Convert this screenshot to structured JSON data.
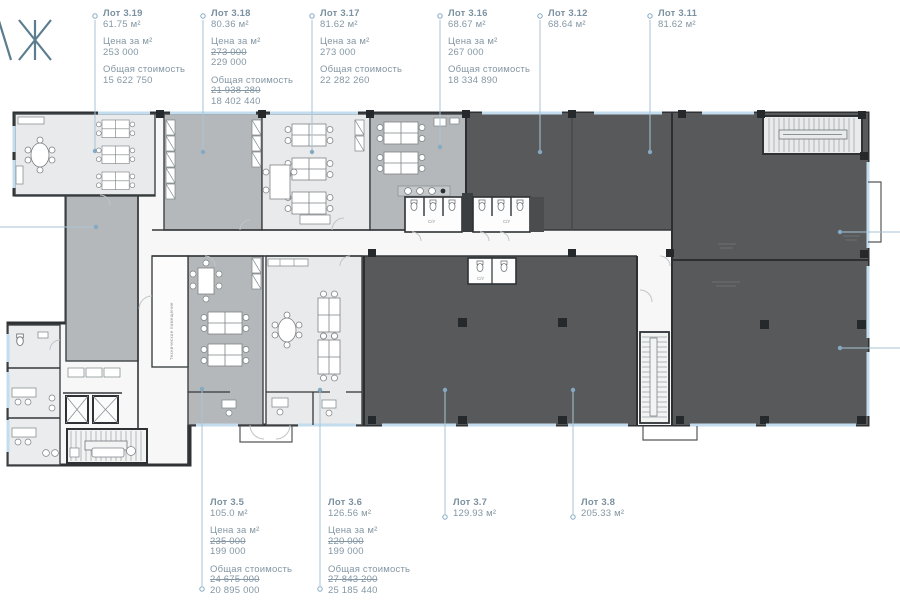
{
  "logo": {
    "visible_letters": "АЖ"
  },
  "labels": {
    "price_caption": "Цена за м²",
    "total_caption": "Общая стоимость"
  },
  "lots": {
    "top": [
      {
        "title": "Лот 3.19",
        "area": "61.75 м²",
        "price": "253 000",
        "total": "15 622 750"
      },
      {
        "title": "Лот 3.18",
        "area": "80.36 м²",
        "price_old": "273 000",
        "price": "229 000",
        "total_old": "21 938 280",
        "total": "18 402 440"
      },
      {
        "title": "Лот 3.17",
        "area": "81.62 м²",
        "price": "273 000",
        "total": "22 282 260"
      },
      {
        "title": "Лот 3.16",
        "area": "68.67 м²",
        "price": "267 000",
        "total": "18 334 890"
      },
      {
        "title": "Лот 3.12",
        "area": "68.64 м²"
      },
      {
        "title": "Лот 3.11",
        "area": "81.62 м²"
      }
    ],
    "bottom": [
      {
        "title": "Лот 3.5",
        "area": "105.0 м²",
        "price_old": "235 000",
        "price": "199 000",
        "total_old": "24 675 000",
        "total": "20 895 000"
      },
      {
        "title": "Лот 3.6",
        "area": "126.56 м²",
        "price_old": "220 000",
        "price": "199 000",
        "total_old": "27 843 200",
        "total": "25 185 440"
      },
      {
        "title": "Лот 3.7",
        "area": "129.93 м²"
      },
      {
        "title": "Лот 3.8",
        "area": "205.33 м²"
      }
    ]
  },
  "plan": {
    "wc_label": "С/У",
    "tech_room_label": "Техническое помещение",
    "colors": {
      "dark_room": "#58595b",
      "medium_room": "#b5b8ba",
      "light_room": "#e9eaeb",
      "corridor": "#f6f7f6",
      "wall": "#2e3235",
      "window": "#c3dcee",
      "leader": "#a9c3d6",
      "label_text": "#8497a4"
    }
  }
}
